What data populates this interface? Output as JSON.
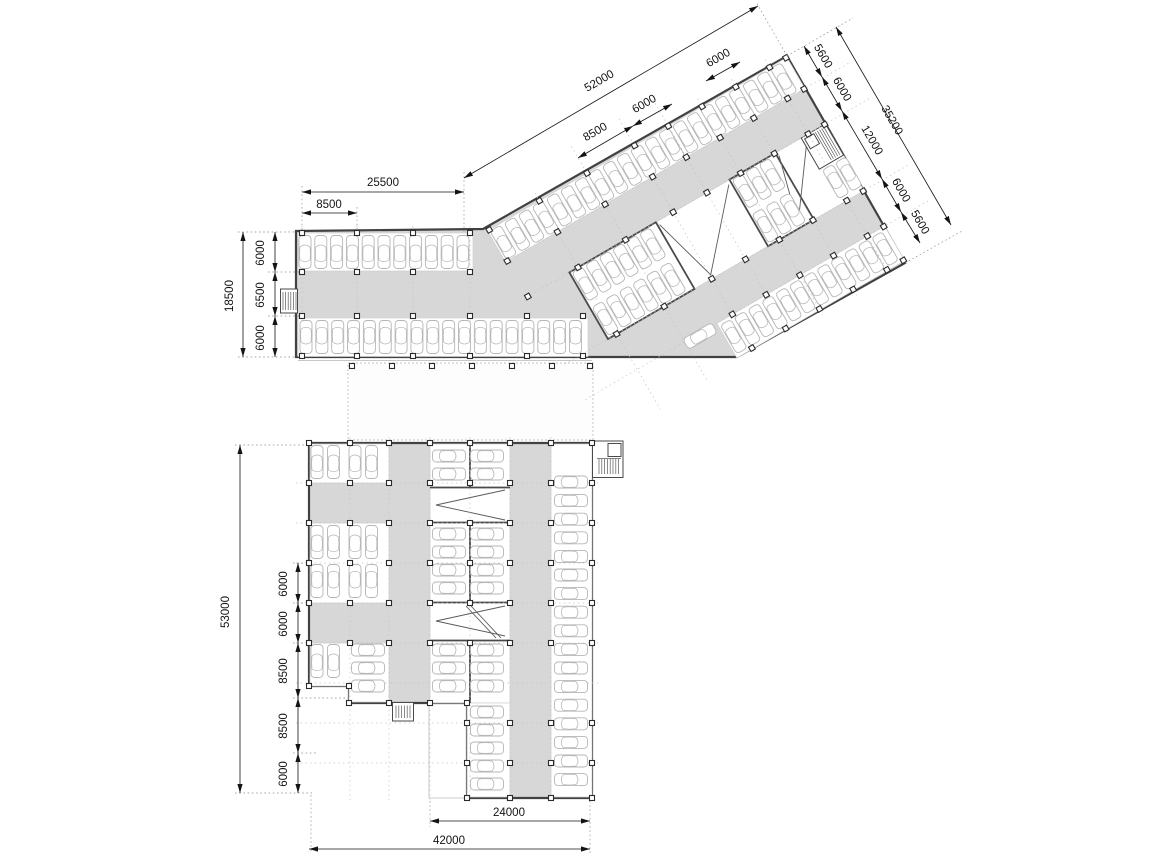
{
  "colors": {
    "aisle_fill": "#d7d7d7",
    "wall": "#414141",
    "car_outline": "#b6b6b6",
    "dimension": "#141414",
    "grid_dash": "#c3c3c3"
  },
  "dims": {
    "upper": {
      "wing_length": "52000",
      "wing_bay_a": "8500",
      "wing_bay_b": "6000",
      "top_bay": "6000",
      "bar_length": "25500",
      "bar_bay": "8500",
      "right_chain": [
        "5600",
        "6000",
        "12000",
        "6000",
        "5600"
      ],
      "wing_width": "35200",
      "bar_width": "18500",
      "bar_chain": [
        "6000",
        "6500",
        "6000"
      ]
    },
    "lower": {
      "total_depth": "53000",
      "left_chain": [
        "6000",
        "6000",
        "8500",
        "8500",
        "6000"
      ],
      "inner_width": "24000",
      "total_width": "42000"
    }
  }
}
